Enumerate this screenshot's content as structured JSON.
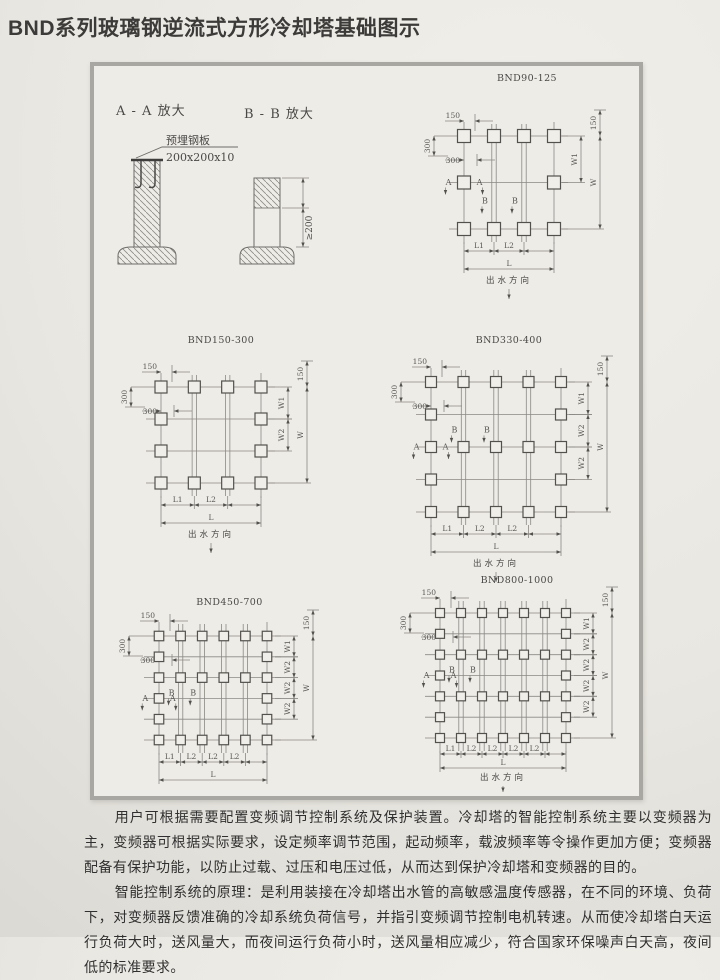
{
  "page": {
    "title": "BND系列玻璃钢逆流式方形冷却塔基础图示"
  },
  "details": {
    "label_aa": "A - A 放大",
    "label_bb": "B - B 放大",
    "plate_line1": "预埋钢板",
    "plate_line2": "200x200x10",
    "min_height": "≥200"
  },
  "plan_common": {
    "dim_top": "150",
    "dim_left": "300",
    "dim_right": "150",
    "outflow": "出水方向",
    "marker_a": "A",
    "marker_b": "B"
  },
  "diagrams": [
    {
      "id": "bnd90-125",
      "title": "BND90-125",
      "cols": 4,
      "rows": 3,
      "rail_pad_rows": [
        0,
        2
      ],
      "pad": 13,
      "grid": {
        "gl": 42,
        "gt": 66,
        "gr": 132,
        "gb": 159
      },
      "w_gaps": [
        "W1",
        null
      ],
      "w_total": "W",
      "l_gaps": [
        "L1",
        "L2",
        null
      ],
      "l_total": "L",
      "outflow": true,
      "a_row": 1,
      "b_pos": 1.45,
      "compact": false
    },
    {
      "id": "bnd150-300",
      "title": "BND150-300",
      "cols": 4,
      "rows": 4,
      "rail_pad_rows": [
        0,
        3
      ],
      "pad": 12,
      "grid": {
        "gl": 51,
        "gt": 55,
        "gr": 151,
        "gb": 151
      },
      "w_gaps": [
        "W1",
        "W2",
        null
      ],
      "w_total": "W",
      "l_gaps": [
        "L1",
        "L2",
        null
      ],
      "l_total": "L",
      "outflow": true,
      "a_row": null,
      "b_pos": null,
      "compact": false
    },
    {
      "id": "bnd330-400",
      "title": "BND330-400",
      "cols": 5,
      "rows": 5,
      "rail_pad_rows": [
        0,
        2,
        4
      ],
      "pad": 11,
      "grid": {
        "gl": 37,
        "gt": 50,
        "gr": 167,
        "gb": 180
      },
      "w_gaps": [
        "W1",
        "W2",
        "W2",
        null
      ],
      "w_total": "W",
      "l_gaps": [
        "L1",
        "L2",
        "L2",
        null
      ],
      "l_total": "L",
      "outflow": true,
      "a_row": 2,
      "b_pos": 1.55,
      "compact": false
    },
    {
      "id": "bnd450-700",
      "title": "BND450-700",
      "cols": 6,
      "rows": 6,
      "rail_pad_rows": [
        0,
        2,
        5
      ],
      "pad": 9.5,
      "grid": {
        "gl": 37,
        "gt": 42,
        "gr": 145,
        "gb": 146
      },
      "w_gaps": [
        "W1",
        "W2",
        "W2",
        "W2",
        null
      ],
      "w_total": "W",
      "l_gaps": [
        "L1",
        "L2",
        "L2",
        "L2",
        null
      ],
      "l_total": "L",
      "outflow": false,
      "a_row": 3,
      "b_pos": 2.85,
      "compact": false
    },
    {
      "id": "bnd800-1000",
      "title": "BND800-1000",
      "cols": 7,
      "rows": 7,
      "rail_pad_rows": [
        0,
        2,
        4,
        6
      ],
      "pad": 9,
      "grid": {
        "gl": 36,
        "gt": 41,
        "gr": 162,
        "gb": 166
      },
      "w_gaps": [
        "W1",
        "W2",
        "W2",
        "W2",
        "W2",
        null
      ],
      "w_total": "W",
      "l_gaps": [
        "L1",
        "L2",
        "L2",
        "L2",
        "L2",
        null
      ],
      "l_total": "L",
      "outflow": true,
      "a_row": 3,
      "b_pos": 2.85,
      "compact": true
    }
  ],
  "paragraphs": [
    "用户可根据需要配置变频调节控制系统及保护装置。冷却塔的智能控制系统主要以变频器为主，变频器可根据实际要求，设定频率调节范围，起动频率，载波频率等令操作更加方便；变频器配备有保护功能，以防止过载、过压和电压过低，从而达到保护冷却塔和变频器的目的。",
    "智能控制系统的原理：是利用装接在冷却塔出水管的高敏感温度传感器，在不同的环境、负荷下，对变频器反馈准确的冷却系统负荷信号，并指引变频调节控制电机转速。从而使冷却塔白天运行负荷大时，送风量大，而夜间运行负荷小时，送风量相应减少，符合国家环保噪声白天高，夜间低的标准要求。"
  ]
}
